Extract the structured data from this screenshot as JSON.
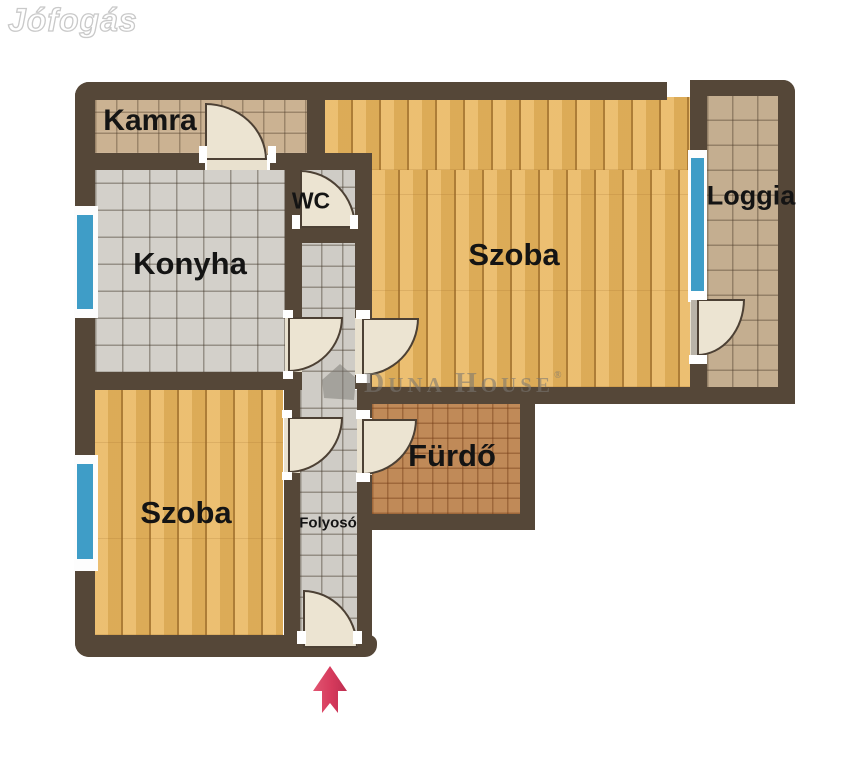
{
  "watermarks": {
    "jofogas": "Jófogás",
    "duna_house": {
      "d": "D",
      "una": "UNA",
      "h": "H",
      "ouse": "OUSE",
      "reg": "®"
    }
  },
  "rooms": {
    "kamra": {
      "label": "Kamra"
    },
    "konyha": {
      "label": "Konyha"
    },
    "wc": {
      "label": "WC"
    },
    "szoba1": {
      "label": "Szoba"
    },
    "loggia": {
      "label": "Loggia"
    },
    "furdo": {
      "label": "Fürdő"
    },
    "szoba2": {
      "label": "Szoba"
    },
    "folyoso": {
      "label": "Folyosó"
    }
  },
  "entrance_arrow": {
    "direction": "up",
    "color_left": "#e25672",
    "color_right": "#bd2e50"
  },
  "colors": {
    "wall": "#554738",
    "wood_floor": "#e8b45c",
    "tan_tile": "#cbb292",
    "gray_tile": "#d3d0ca",
    "bath_tile": "#c08a58",
    "window_blue": "#3f9dc7",
    "door_leaf": "#ece4d2",
    "background": "#ffffff"
  }
}
